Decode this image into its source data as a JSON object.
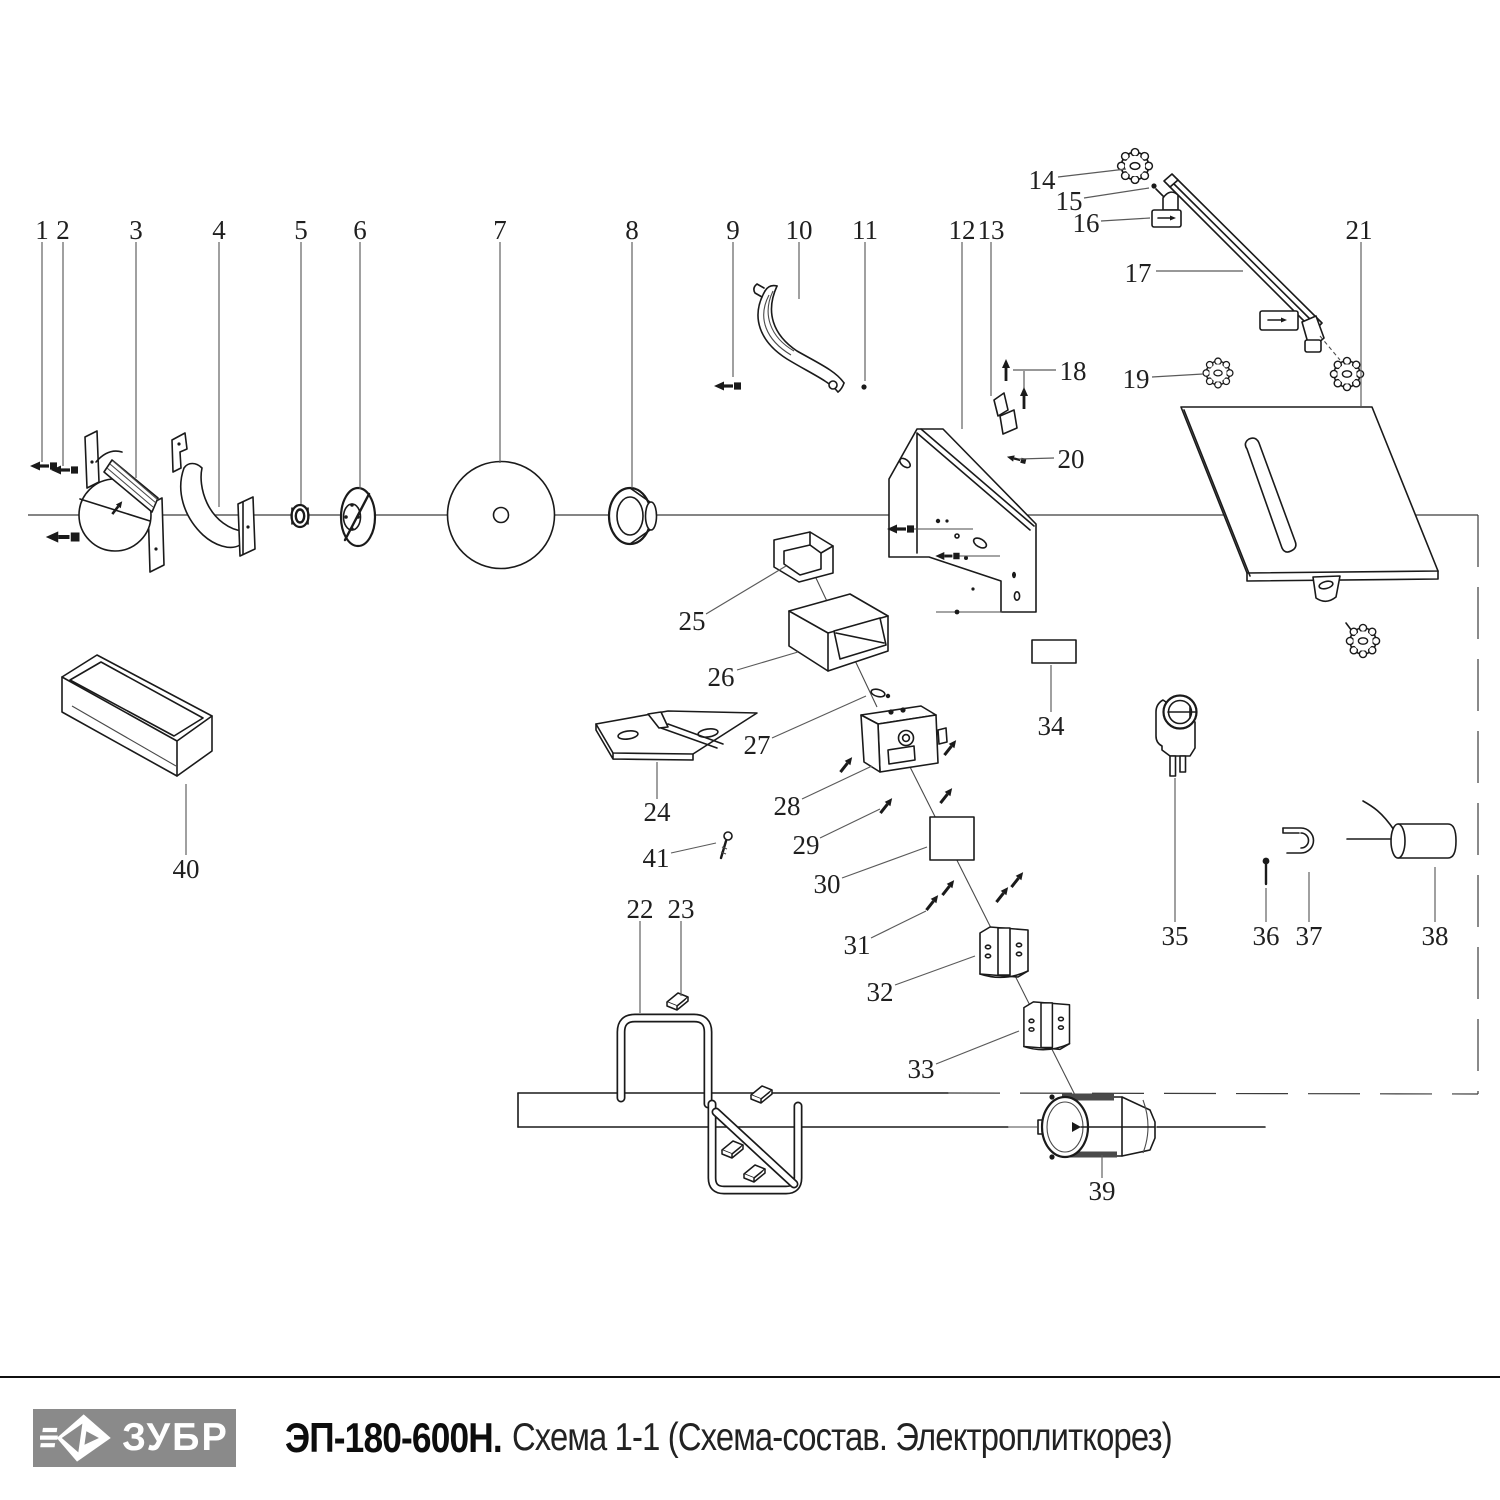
{
  "footer": {
    "logo": {
      "text": "ЗУБР",
      "bg": "#8a8a8a"
    },
    "title_model": "ЭП-180-600Н.",
    "title_rest": "Схема 1-1 (Схема-состав. Электроплиткорез)"
  },
  "diagram": {
    "accent_stroke": "#1a1a1a",
    "leader_color": "#5a5a5a",
    "callouts": [
      {
        "n": "1",
        "x": 42,
        "y": 230,
        "line": [
          [
            42,
            242
          ],
          [
            42,
            462
          ]
        ]
      },
      {
        "n": "2",
        "x": 63,
        "y": 230,
        "line": [
          [
            63,
            242
          ],
          [
            63,
            466
          ]
        ]
      },
      {
        "n": "3",
        "x": 136,
        "y": 230,
        "line": [
          [
            136,
            242
          ],
          [
            136,
            478
          ]
        ]
      },
      {
        "n": "4",
        "x": 219,
        "y": 230,
        "line": [
          [
            219,
            242
          ],
          [
            219,
            507
          ]
        ]
      },
      {
        "n": "5",
        "x": 301,
        "y": 230,
        "line": [
          [
            301,
            242
          ],
          [
            301,
            504
          ]
        ]
      },
      {
        "n": "6",
        "x": 360,
        "y": 230,
        "line": [
          [
            360,
            242
          ],
          [
            360,
            489
          ]
        ]
      },
      {
        "n": "7",
        "x": 500,
        "y": 230,
        "line": [
          [
            500,
            242
          ],
          [
            500,
            463
          ]
        ]
      },
      {
        "n": "8",
        "x": 632,
        "y": 230,
        "line": [
          [
            632,
            242
          ],
          [
            632,
            488
          ]
        ]
      },
      {
        "n": "9",
        "x": 733,
        "y": 230,
        "line": [
          [
            733,
            242
          ],
          [
            733,
            377
          ]
        ]
      },
      {
        "n": "10",
        "x": 799,
        "y": 230,
        "line": [
          [
            799,
            242
          ],
          [
            799,
            299
          ]
        ]
      },
      {
        "n": "11",
        "x": 865,
        "y": 230,
        "line": [
          [
            865,
            242
          ],
          [
            865,
            381
          ]
        ]
      },
      {
        "n": "12",
        "x": 962,
        "y": 230,
        "line": [
          [
            962,
            242
          ],
          [
            962,
            429
          ]
        ]
      },
      {
        "n": "13",
        "x": 991,
        "y": 230,
        "line": [
          [
            991,
            242
          ],
          [
            991,
            396
          ]
        ]
      },
      {
        "n": "14",
        "x": 1042,
        "y": 180,
        "line": [
          [
            1058,
            177
          ],
          [
            1126,
            169
          ]
        ]
      },
      {
        "n": "15",
        "x": 1069,
        "y": 201,
        "line": [
          [
            1084,
            198
          ],
          [
            1149,
            188
          ]
        ]
      },
      {
        "n": "16",
        "x": 1086,
        "y": 223,
        "line": [
          [
            1101,
            221
          ],
          [
            1150,
            218
          ]
        ]
      },
      {
        "n": "17",
        "x": 1138,
        "y": 273,
        "line": [
          [
            1156,
            271
          ],
          [
            1243,
            271
          ]
        ]
      },
      {
        "n": "18",
        "x": 1073,
        "y": 371,
        "line": [
          [
            1056,
            370
          ],
          [
            1013,
            370
          ]
        ]
      },
      {
        "n": "19",
        "x": 1136,
        "y": 379,
        "line": [
          [
            1152,
            377
          ],
          [
            1203,
            374
          ]
        ]
      },
      {
        "n": "20",
        "x": 1071,
        "y": 459,
        "line": [
          [
            1054,
            458
          ],
          [
            1019,
            459
          ]
        ]
      },
      {
        "n": "21",
        "x": 1359,
        "y": 230,
        "line": [
          [
            1361,
            242
          ],
          [
            1361,
            406
          ]
        ]
      },
      {
        "n": "22",
        "x": 640,
        "y": 909,
        "line": [
          [
            640,
            921
          ],
          [
            640,
            1013
          ]
        ]
      },
      {
        "n": "23",
        "x": 681,
        "y": 909,
        "line": [
          [
            681,
            921
          ],
          [
            681,
            996
          ]
        ]
      },
      {
        "n": "24",
        "x": 657,
        "y": 812,
        "line": [
          [
            657,
            799
          ],
          [
            657,
            762
          ]
        ]
      },
      {
        "n": "25",
        "x": 692,
        "y": 621,
        "line": [
          [
            706,
            614
          ],
          [
            786,
            566
          ]
        ]
      },
      {
        "n": "26",
        "x": 721,
        "y": 677,
        "line": [
          [
            737,
            670
          ],
          [
            798,
            652
          ]
        ]
      },
      {
        "n": "27",
        "x": 757,
        "y": 745,
        "line": [
          [
            772,
            738
          ],
          [
            866,
            696
          ]
        ]
      },
      {
        "n": "28",
        "x": 787,
        "y": 806,
        "line": [
          [
            802,
            799
          ],
          [
            872,
            766
          ]
        ]
      },
      {
        "n": "29",
        "x": 806,
        "y": 845,
        "line": [
          [
            820,
            838
          ],
          [
            880,
            809
          ]
        ]
      },
      {
        "n": "30",
        "x": 827,
        "y": 884,
        "line": [
          [
            842,
            878
          ],
          [
            927,
            847
          ]
        ]
      },
      {
        "n": "31",
        "x": 857,
        "y": 945,
        "line": [
          [
            871,
            938
          ],
          [
            926,
            911
          ]
        ]
      },
      {
        "n": "32",
        "x": 880,
        "y": 992,
        "line": [
          [
            895,
            985
          ],
          [
            975,
            956
          ]
        ]
      },
      {
        "n": "33",
        "x": 921,
        "y": 1069,
        "line": [
          [
            936,
            1064
          ],
          [
            1019,
            1031
          ]
        ]
      },
      {
        "n": "34",
        "x": 1051,
        "y": 726,
        "line": [
          [
            1051,
            712
          ],
          [
            1051,
            665
          ]
        ]
      },
      {
        "n": "35",
        "x": 1175,
        "y": 936,
        "line": [
          [
            1175,
            922
          ],
          [
            1175,
            778
          ]
        ]
      },
      {
        "n": "36",
        "x": 1266,
        "y": 936,
        "line": [
          [
            1266,
            922
          ],
          [
            1266,
            888
          ]
        ]
      },
      {
        "n": "37",
        "x": 1309,
        "y": 936,
        "line": [
          [
            1309,
            922
          ],
          [
            1309,
            872
          ]
        ]
      },
      {
        "n": "38",
        "x": 1435,
        "y": 936,
        "line": [
          [
            1435,
            922
          ],
          [
            1435,
            867
          ]
        ]
      },
      {
        "n": "39",
        "x": 1102,
        "y": 1191,
        "line": [
          [
            1102,
            1178
          ],
          [
            1102,
            1155
          ]
        ]
      },
      {
        "n": "40",
        "x": 186,
        "y": 869,
        "line": [
          [
            186,
            855
          ],
          [
            186,
            784
          ]
        ]
      },
      {
        "n": "41",
        "x": 656,
        "y": 858,
        "line": [
          [
            671,
            853
          ],
          [
            716,
            843
          ]
        ]
      }
    ]
  }
}
